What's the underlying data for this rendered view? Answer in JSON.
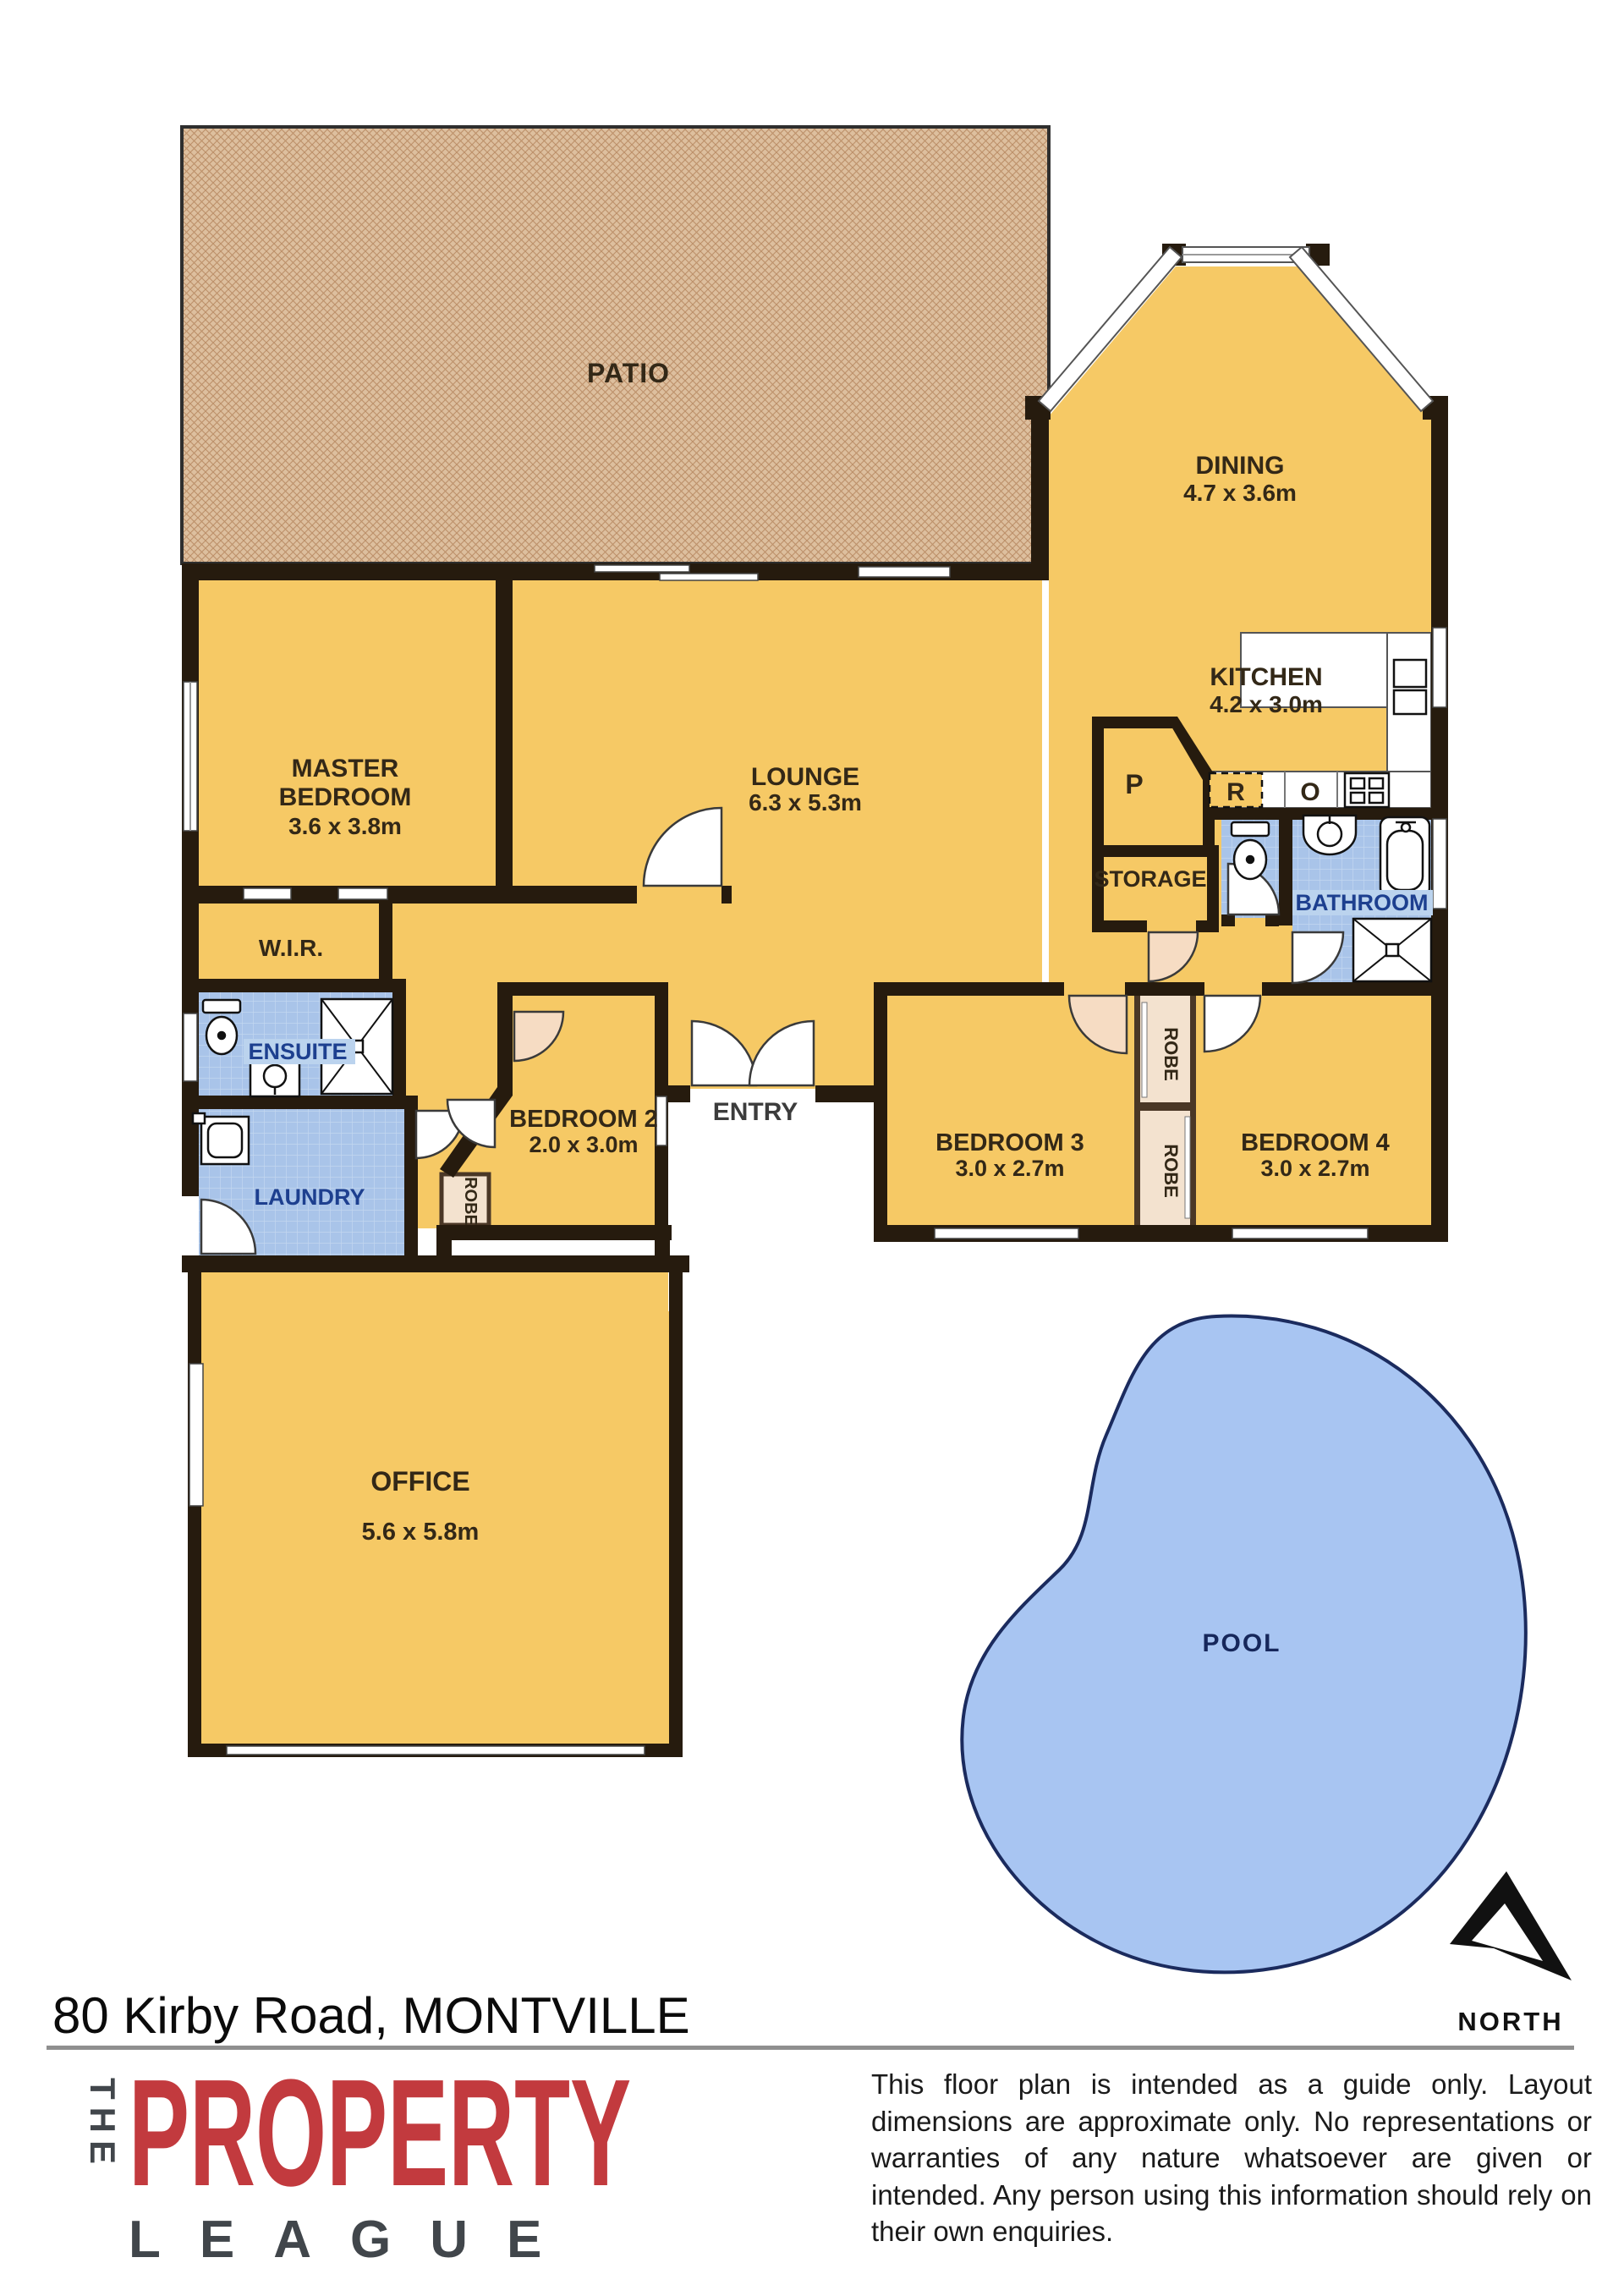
{
  "header": {
    "address": "80 Kirby Road, MONTVILLE"
  },
  "compass": {
    "label": "NORTH"
  },
  "rooms": {
    "patio": {
      "name": "PATIO"
    },
    "dining": {
      "name": "DINING",
      "dims": "4.7 x 3.6m"
    },
    "kitchen": {
      "name": "KITCHEN",
      "dims": "4.2 x 3.0m"
    },
    "lounge": {
      "name": "LOUNGE",
      "dims": "6.3 x 5.3m"
    },
    "master": {
      "name1": "MASTER",
      "name2": "BEDROOM",
      "dims": "3.6 x 3.8m"
    },
    "wir": {
      "name": "W.I.R."
    },
    "ensuite": {
      "name": "ENSUITE"
    },
    "laundry": {
      "name": "LAUNDRY"
    },
    "storage": {
      "name": "STORAGE"
    },
    "bathroom": {
      "name": "BATHROOM"
    },
    "entry": {
      "name": "ENTRY"
    },
    "bedroom2": {
      "name": "BEDROOM 2",
      "dims": "2.0 x 3.0m"
    },
    "bedroom3": {
      "name": "BEDROOM 3",
      "dims": "3.0 x 2.7m"
    },
    "bedroom4": {
      "name": "BEDROOM 4",
      "dims": "3.0 x 2.7m"
    },
    "office": {
      "name": "OFFICE",
      "dims": "5.6 x 5.8m"
    },
    "pool": {
      "name": "POOL"
    },
    "robe": {
      "name": "ROBE"
    }
  },
  "appliances": {
    "pantry": "P",
    "refrigerator": "R",
    "oven": "O"
  },
  "branding": {
    "the": "THE",
    "property": "PROPERTY",
    "league": "LEAGUE"
  },
  "disclaimer": "This floor plan is intended as a guide only. Layout dimensions are approximate only. No representations or warranties of any nature whatsoever are given or intended. Any person using this information should rely on their own enquiries.",
  "colors": {
    "room_fill": "#F6C965",
    "wet_fill": "#A9C4E9",
    "patio_fill": "#DDBF9E",
    "pool_fill": "#A8C5F2",
    "wall": "#261B0E",
    "brand_red": "#C23A3E",
    "label_navy": "#1D3F8F"
  }
}
